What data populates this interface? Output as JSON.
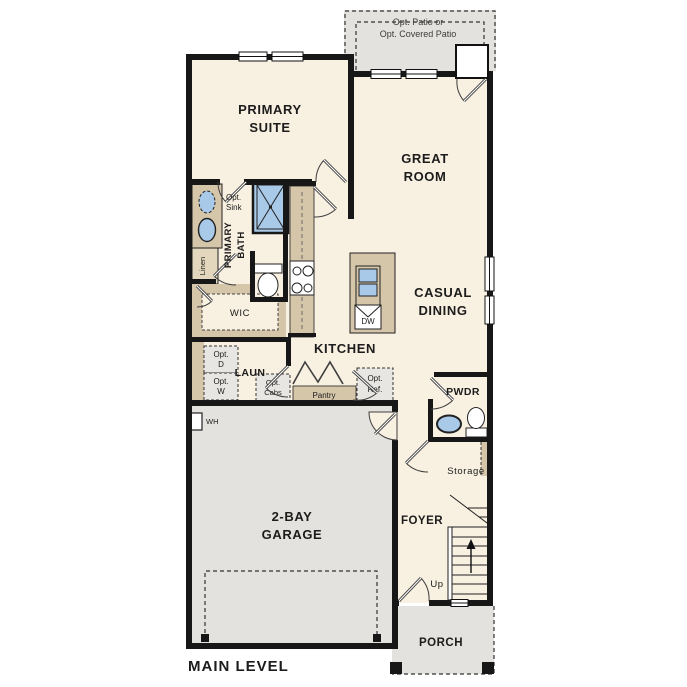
{
  "plan": {
    "level_label": "MAIN LEVEL",
    "patio": {
      "line1": "Opt. Patio or",
      "line2": "Opt. Covered Patio"
    },
    "primary_suite": {
      "line1": "PRIMARY",
      "line2": "SUITE"
    },
    "great_room": {
      "line1": "GREAT",
      "line2": "ROOM"
    },
    "casual_dining": {
      "line1": "CASUAL",
      "line2": "DINING"
    },
    "kitchen": {
      "label": "KITCHEN"
    },
    "primary_bath": {
      "line1": "PRIMARY",
      "line2": "BATH"
    },
    "opt_sink": {
      "line1": "Opt.",
      "line2": "Sink"
    },
    "linen": {
      "label": "Linen"
    },
    "wic": {
      "label": "WIC"
    },
    "laundry": {
      "label": "LAUN"
    },
    "opt_dryer": {
      "line1": "Opt.",
      "line2": "D"
    },
    "opt_washer": {
      "line1": "Opt.",
      "line2": "W"
    },
    "opt_cabs": {
      "line1": "Opt.",
      "line2": "Cabs"
    },
    "pantry": {
      "label": "Pantry"
    },
    "opt_ref": {
      "line1": "Opt.",
      "line2": "Ref."
    },
    "dishwasher": {
      "label": "DW"
    },
    "powder": {
      "label": "PWDR"
    },
    "storage": {
      "label": "Storage"
    },
    "foyer": {
      "label": "FOYER"
    },
    "stairs": {
      "up_label": "Up"
    },
    "water_heater": {
      "label": "WH"
    },
    "garage": {
      "line1": "2-BAY",
      "line2": "GARAGE"
    },
    "porch": {
      "label": "PORCH"
    }
  },
  "colors": {
    "room_fill": "#f8f0e1",
    "garage_fill": "#e3e2de",
    "cabinet_tan": "#d5c6aa",
    "fixture_blue": "#a9c9e9",
    "wall": "#171717",
    "option_box_fill": "#e7e6e2"
  }
}
